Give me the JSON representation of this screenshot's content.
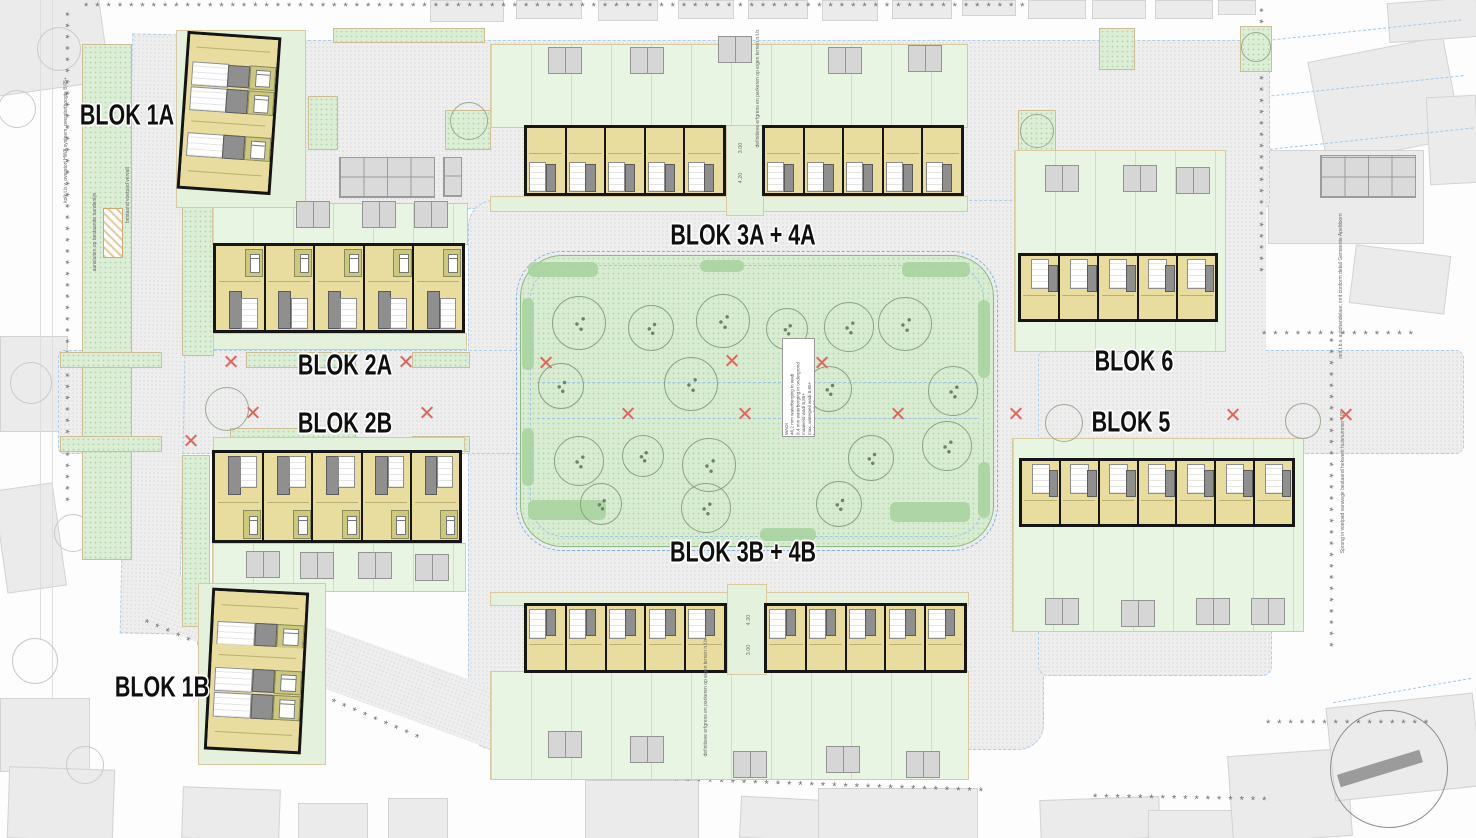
{
  "colors": {
    "unit_tan": "#e8dd9e",
    "bedroom_olive": "#cdc97c",
    "wall_black": "#161616",
    "core_gray": "#8f8f8f",
    "park_green": "#d8ecd2",
    "verge_green": "#dcefd6",
    "garden_green": "#e9f5e3",
    "paving_gray": "#eeeeee",
    "building_gray": "#ebebeb",
    "curb_blue": "#7fb2e0",
    "mark_red": "#e2645c",
    "hedge_sage": "#c2cf9e"
  },
  "boundary": {
    "marker": "*",
    "segments": [
      [
        84,
        2,
        1175,
        0
      ],
      [
        70,
        12,
        612,
        90
      ],
      [
        146,
        618,
        378,
        23
      ],
      [
        494,
        770,
        604,
        2
      ],
      [
        1093,
        793,
        220,
        1
      ],
      [
        1264,
        8,
        330,
        90
      ],
      [
        1262,
        330,
        196,
        0
      ],
      [
        1334,
        338,
        392,
        90
      ],
      [
        1266,
        719,
        206,
        0
      ]
    ]
  },
  "labels": [
    {
      "text": "BLOK 1A",
      "x": 127,
      "y": 116
    },
    {
      "text": "BLOK 2A",
      "x": 345,
      "y": 366
    },
    {
      "text": "BLOK 2B",
      "x": 345,
      "y": 424
    },
    {
      "text": "BLOK 1B",
      "x": 162,
      "y": 688
    },
    {
      "text": "BLOK 3A + 4A",
      "x": 743,
      "y": 236
    },
    {
      "text": "BLOK 3B + 4B",
      "x": 743,
      "y": 553
    },
    {
      "text": "BLOK 6",
      "x": 1134,
      "y": 362
    },
    {
      "text": "BLOK 5",
      "x": 1131,
      "y": 423
    }
  ],
  "notes": [
    {
      "x": 66,
      "y": 140,
      "text": "kolk t.b.v. overstort HWA systeem, overstorthoogte 8,65+"
    },
    {
      "x": 128,
      "y": 195,
      "text": "bestaand voetpad vervalt"
    },
    {
      "x": 95,
      "y": 232,
      "text": "aansluiten op bestaande bandenlijn"
    },
    {
      "x": 758,
      "y": 88,
      "text": "definitieve erfgrens en parkeren op eigen terrein n.t.b."
    },
    {
      "x": 706,
      "y": 697,
      "text": "definitieve erfgrens en parkeren op eigen terrein n.t.b."
    },
    {
      "x": 1343,
      "y": 482,
      "text": "Sprong in voetpad vanwege bestaand hekwerk huisnummer 109"
    },
    {
      "x": 1341,
      "y": 286,
      "text": "inrit t.b.v. autohandelaar, inrit conform detail Gemeente Apeldoorn"
    }
  ],
  "dims": [
    {
      "x": 741,
      "y": 148,
      "text": "3.00"
    },
    {
      "x": 741,
      "y": 178,
      "text": "4.20"
    },
    {
      "x": 749,
      "y": 620,
      "text": "4.20"
    },
    {
      "x": 749,
      "y": 650,
      "text": "3.00"
    }
  ],
  "wadi": {
    "x": 782,
    "y": 338,
    "w": 31,
    "h": 97,
    "text": "WADI\n46,2 mm waterberging in wadi\n9,4 mm waterberging in ondergrond\nmaaiveld wadi 8,85+\nmax. waterpeil wadi 8,65+\nbodem wadi 8,35+"
  },
  "park": {
    "x": 520,
    "y": 255,
    "w": 472,
    "h": 290,
    "trees": [
      [
        578,
        322,
        26
      ],
      [
        650,
        327,
        22
      ],
      [
        722,
        320,
        26
      ],
      [
        786,
        328,
        20
      ],
      [
        848,
        326,
        24
      ],
      [
        904,
        323,
        26
      ],
      [
        560,
        385,
        22
      ],
      [
        690,
        383,
        26
      ],
      [
        828,
        388,
        22
      ],
      [
        952,
        390,
        24
      ],
      [
        578,
        460,
        24
      ],
      [
        642,
        455,
        20
      ],
      [
        708,
        464,
        26
      ],
      [
        870,
        457,
        22
      ],
      [
        946,
        445,
        24
      ],
      [
        600,
        503,
        20
      ],
      [
        705,
        507,
        24
      ],
      [
        838,
        503,
        22
      ]
    ],
    "patches": [
      [
        528,
        262,
        70,
        15
      ],
      [
        700,
        260,
        44,
        12
      ],
      [
        902,
        262,
        68,
        15
      ],
      [
        522,
        298,
        12,
        72
      ],
      [
        978,
        300,
        12,
        78
      ],
      [
        528,
        500,
        78,
        20
      ],
      [
        890,
        502,
        80,
        20
      ],
      [
        522,
        428,
        12,
        58
      ],
      [
        760,
        528,
        56,
        13
      ],
      [
        978,
        462,
        12,
        56
      ]
    ]
  },
  "xmarks": [
    [
      545,
      362
    ],
    [
      731,
      360
    ],
    [
      821,
      362
    ],
    [
      627,
      413
    ],
    [
      744,
      413
    ],
    [
      897,
      413
    ],
    [
      230,
      361
    ],
    [
      405,
      361
    ],
    [
      252,
      412
    ],
    [
      426,
      412
    ],
    [
      190,
      440
    ],
    [
      1015,
      413
    ],
    [
      1232,
      414
    ],
    [
      1345,
      414
    ],
    [
      1146,
      362
    ]
  ],
  "trees_street": [
    [
      226,
      408,
      21
    ],
    [
      468,
      120,
      18
    ],
    [
      1036,
      130,
      16
    ],
    [
      1255,
      46,
      14
    ],
    [
      1063,
      422,
      18
    ],
    [
      1302,
      420,
      17
    ]
  ],
  "trees_faint": [
    [
      58,
      48,
      21
    ],
    [
      16,
      108,
      18
    ],
    [
      30,
      382,
      20
    ],
    [
      72,
      532,
      18
    ],
    [
      34,
      660,
      22
    ],
    [
      84,
      764,
      18
    ],
    [
      240,
      86,
      16
    ]
  ],
  "cars": [
    [
      548,
      47
    ],
    [
      630,
      47
    ],
    [
      718,
      36
    ],
    [
      828,
      47
    ],
    [
      908,
      45
    ],
    [
      548,
      731
    ],
    [
      630,
      736
    ],
    [
      733,
      751
    ],
    [
      826,
      746
    ],
    [
      906,
      751
    ],
    [
      296,
      201
    ],
    [
      362,
      201
    ],
    [
      414,
      201
    ],
    [
      246,
      551
    ],
    [
      300,
      552
    ],
    [
      358,
      552
    ],
    [
      415,
      554
    ],
    [
      1045,
      598
    ],
    [
      1121,
      600
    ],
    [
      1196,
      598
    ],
    [
      1251,
      598
    ],
    [
      1045,
      165
    ],
    [
      1123,
      165
    ],
    [
      1176,
      167
    ]
  ],
  "grids": [
    [
      339,
      157,
      94,
      39
    ],
    [
      1320,
      155,
      94,
      41
    ],
    [
      443,
      157,
      17,
      38
    ]
  ],
  "buildings": [
    [
      -20,
      -14,
      122,
      102,
      -8
    ],
    [
      0,
      336,
      66,
      94,
      0
    ],
    [
      0,
      486,
      58,
      102,
      -8
    ],
    [
      0,
      698,
      88,
      72,
      0
    ],
    [
      8,
      768,
      104,
      70,
      2
    ],
    [
      430,
      0,
      72,
      20,
      0
    ],
    [
      516,
      0,
      64,
      17,
      0
    ],
    [
      598,
      0,
      58,
      19,
      0
    ],
    [
      678,
      0,
      54,
      17,
      0
    ],
    [
      748,
      0,
      58,
      17,
      0
    ],
    [
      822,
      0,
      54,
      19,
      0
    ],
    [
      892,
      0,
      58,
      17,
      0
    ],
    [
      962,
      0,
      52,
      14,
      0
    ],
    [
      1028,
      0,
      56,
      17,
      0
    ],
    [
      1092,
      0,
      52,
      17,
      0
    ],
    [
      1155,
      0,
      56,
      17,
      0
    ],
    [
      1218,
      0,
      36,
      13,
      0
    ],
    [
      1100,
      53,
      126,
      88,
      -13
    ],
    [
      1316,
      48,
      136,
      102,
      -11
    ],
    [
      1388,
      0,
      88,
      38,
      -4
    ],
    [
      1268,
      150,
      154,
      92,
      0
    ],
    [
      1352,
      250,
      94,
      57,
      7
    ],
    [
      1428,
      96,
      48,
      86,
      -3
    ],
    [
      585,
      780,
      112,
      58,
      0
    ],
    [
      740,
      798,
      88,
      40,
      3
    ],
    [
      818,
      788,
      158,
      50,
      0
    ],
    [
      1040,
      798,
      118,
      40,
      -2
    ],
    [
      1148,
      810,
      148,
      28,
      0
    ],
    [
      1230,
      752,
      118,
      86,
      -4
    ],
    [
      1330,
      700,
      146,
      92,
      -6
    ],
    [
      388,
      798,
      58,
      40,
      0
    ],
    [
      298,
      803,
      68,
      35,
      0
    ],
    [
      182,
      788,
      96,
      50,
      2
    ]
  ],
  "paving": [
    [
      300,
      40,
      968,
      167,
      0,
      8,
      1
    ],
    [
      468,
      200,
      574,
      548,
      0,
      26,
      1
    ],
    [
      1038,
      350,
      424,
      102,
      0,
      8,
      1
    ],
    [
      58,
      350,
      470,
      102,
      0,
      6,
      1
    ],
    [
      126,
      34,
      58,
      598,
      1.2,
      0,
      1
    ],
    [
      140,
      640,
      432,
      58,
      20,
      0,
      0
    ],
    [
      1038,
      600,
      232,
      74,
      0,
      10,
      1
    ],
    [
      1204,
      200,
      62,
      205,
      0,
      0,
      0
    ]
  ],
  "greens": {
    "dotted": [
      [
        82,
        44,
        48,
        514
      ],
      [
        182,
        48,
        30,
        306
      ],
      [
        182,
        455,
        26,
        170
      ],
      [
        60,
        352,
        100,
        14
      ],
      [
        246,
        352,
        108,
        14
      ],
      [
        412,
        352,
        56,
        14
      ],
      [
        60,
        436,
        100,
        14
      ],
      [
        230,
        428,
        124,
        14
      ],
      [
        412,
        436,
        56,
        14
      ],
      [
        1099,
        28,
        34,
        40
      ],
      [
        1240,
        26,
        30,
        44
      ],
      [
        1018,
        110,
        36,
        40
      ],
      [
        308,
        96,
        28,
        52
      ],
      [
        445,
        110,
        44,
        38
      ],
      [
        333,
        28,
        150,
        13
      ]
    ],
    "gardens": [
      [
        490,
        44,
        476,
        82
      ],
      [
        490,
        671,
        477,
        107
      ],
      [
        212,
        203,
        254,
        40
      ],
      [
        212,
        543,
        252,
        47
      ],
      [
        1014,
        150,
        210,
        200
      ],
      [
        1012,
        438,
        290,
        192
      ]
    ],
    "fronts": [
      [
        490,
        196,
        476,
        14
      ],
      [
        490,
        592,
        477,
        12
      ],
      [
        213,
        333,
        252,
        15
      ],
      [
        213,
        437,
        250,
        13
      ],
      [
        726,
        125,
        36,
        89
      ],
      [
        727,
        584,
        38,
        89
      ],
      [
        176,
        30,
        128,
        176
      ],
      [
        198,
        583,
        126,
        180
      ]
    ]
  },
  "lines": [
    [
      1262,
      30,
      200,
      -6
    ],
    [
      1256,
      86,
      208,
      -6
    ],
    [
      1234,
      140,
      240,
      -6
    ],
    [
      1332,
      690,
      140,
      -10
    ]
  ],
  "vlines": [
    [
      40,
      0,
      640
    ],
    [
      52,
      0,
      700
    ]
  ],
  "hatchbox": {
    "x": 103,
    "y": 208,
    "w": 18,
    "h": 48
  },
  "circle": {
    "cx": 1388,
    "cy": 768,
    "r": 58
  },
  "blocks": [
    {
      "x": 524,
      "y": 125,
      "w": 202,
      "h": 71,
      "units": 5,
      "variant": "up"
    },
    {
      "x": 762,
      "y": 125,
      "w": 202,
      "h": 71,
      "units": 5,
      "variant": "up"
    },
    {
      "x": 524,
      "y": 603,
      "w": 203,
      "h": 70,
      "units": 5,
      "variant": "down"
    },
    {
      "x": 764,
      "y": 603,
      "w": 203,
      "h": 70,
      "units": 5,
      "variant": "down"
    },
    {
      "x": 213,
      "y": 243,
      "w": 252,
      "h": 90,
      "units": 5,
      "variant": "a2"
    },
    {
      "x": 212,
      "y": 450,
      "w": 250,
      "h": 93,
      "units": 5,
      "variant": "b2"
    },
    {
      "x": 1018,
      "y": 253,
      "w": 200,
      "h": 69,
      "units": 5,
      "variant": "down5"
    },
    {
      "x": 1019,
      "y": 458,
      "w": 276,
      "h": 69,
      "units": 7,
      "variant": "down5"
    }
  ],
  "apartments": [
    {
      "x": 182,
      "y": 34,
      "w": 94,
      "h": 158,
      "rot": 4,
      "bands": [
        {
          "t": "tan",
          "h": 26
        },
        {
          "t": "mix",
          "h": 24
        },
        {
          "t": "mix",
          "h": 26
        },
        {
          "t": "tan",
          "h": 20
        },
        {
          "t": "mix",
          "h": 26
        },
        {
          "t": "tan",
          "h": 29
        }
      ]
    },
    {
      "x": 208,
      "y": 590,
      "w": 97,
      "h": 162,
      "rot": 3,
      "bands": [
        {
          "t": "tan",
          "h": 28
        },
        {
          "t": "mix",
          "h": 25
        },
        {
          "t": "tan",
          "h": 21
        },
        {
          "t": "mix",
          "h": 25
        },
        {
          "t": "mix",
          "h": 27
        },
        {
          "t": "tan",
          "h": 29
        }
      ]
    }
  ]
}
